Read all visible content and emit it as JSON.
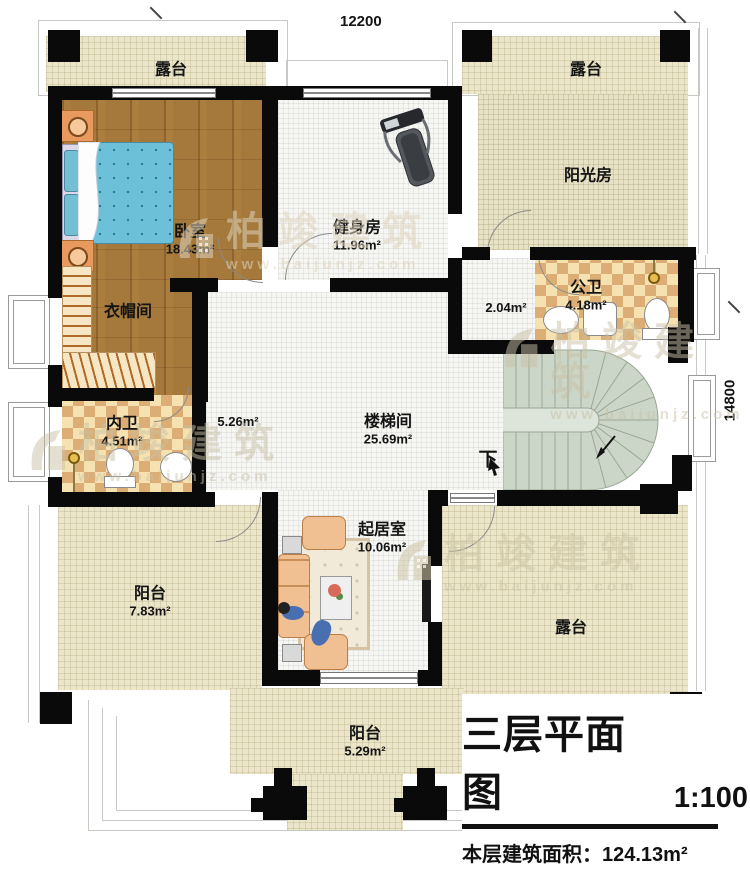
{
  "title_block": {
    "title": "三层平面图",
    "scale": "1:100",
    "area_label": "本层建筑面积：",
    "area_value": "124.13m²",
    "floor_height_label": "层高：",
    "floor_height_value": "3.3m"
  },
  "dimensions": {
    "width": "12200",
    "height": "14800"
  },
  "rooms": {
    "terrace_top_left": {
      "name": "露台"
    },
    "terrace_top_right": {
      "name": "露台"
    },
    "sunroom": {
      "name": "阳光房"
    },
    "bedroom": {
      "name": "卧室",
      "area": "18.43m²"
    },
    "gym": {
      "name": "健身房",
      "area": "11.96m²"
    },
    "cloakroom": {
      "name": "衣帽间"
    },
    "bath_private": {
      "name": "内卫",
      "area": "4.51m²"
    },
    "bath_public": {
      "name": "公卫",
      "area": "4.18m²"
    },
    "closet_small": {
      "area": "2.04m²"
    },
    "hall_small": {
      "area": "5.26m²"
    },
    "stairwell": {
      "name": "楼梯间",
      "area": "25.69m²"
    },
    "living": {
      "name": "起居室",
      "area": "10.06m²"
    },
    "balcony_left": {
      "name": "阳台",
      "area": "7.83m²"
    },
    "terrace_bottom": {
      "name": "露台"
    },
    "balcony_bottom": {
      "name": "阳台",
      "area": "5.29m²"
    },
    "stairs_down": {
      "label": "下"
    }
  },
  "watermark": {
    "brand": "柏竣建筑",
    "url": "www.baijunjz.com"
  },
  "colors": {
    "wall": "#0a0a0a",
    "wood": "#a5793c",
    "terrace": "#ebe6ca",
    "checker_light": "#f6e2b0",
    "checker_dark": "#dcae75",
    "stairs": "#ccd6c8",
    "floor": "#f6f6f3",
    "bed": "#6cc0d8",
    "sofa": "#f0bf92"
  }
}
